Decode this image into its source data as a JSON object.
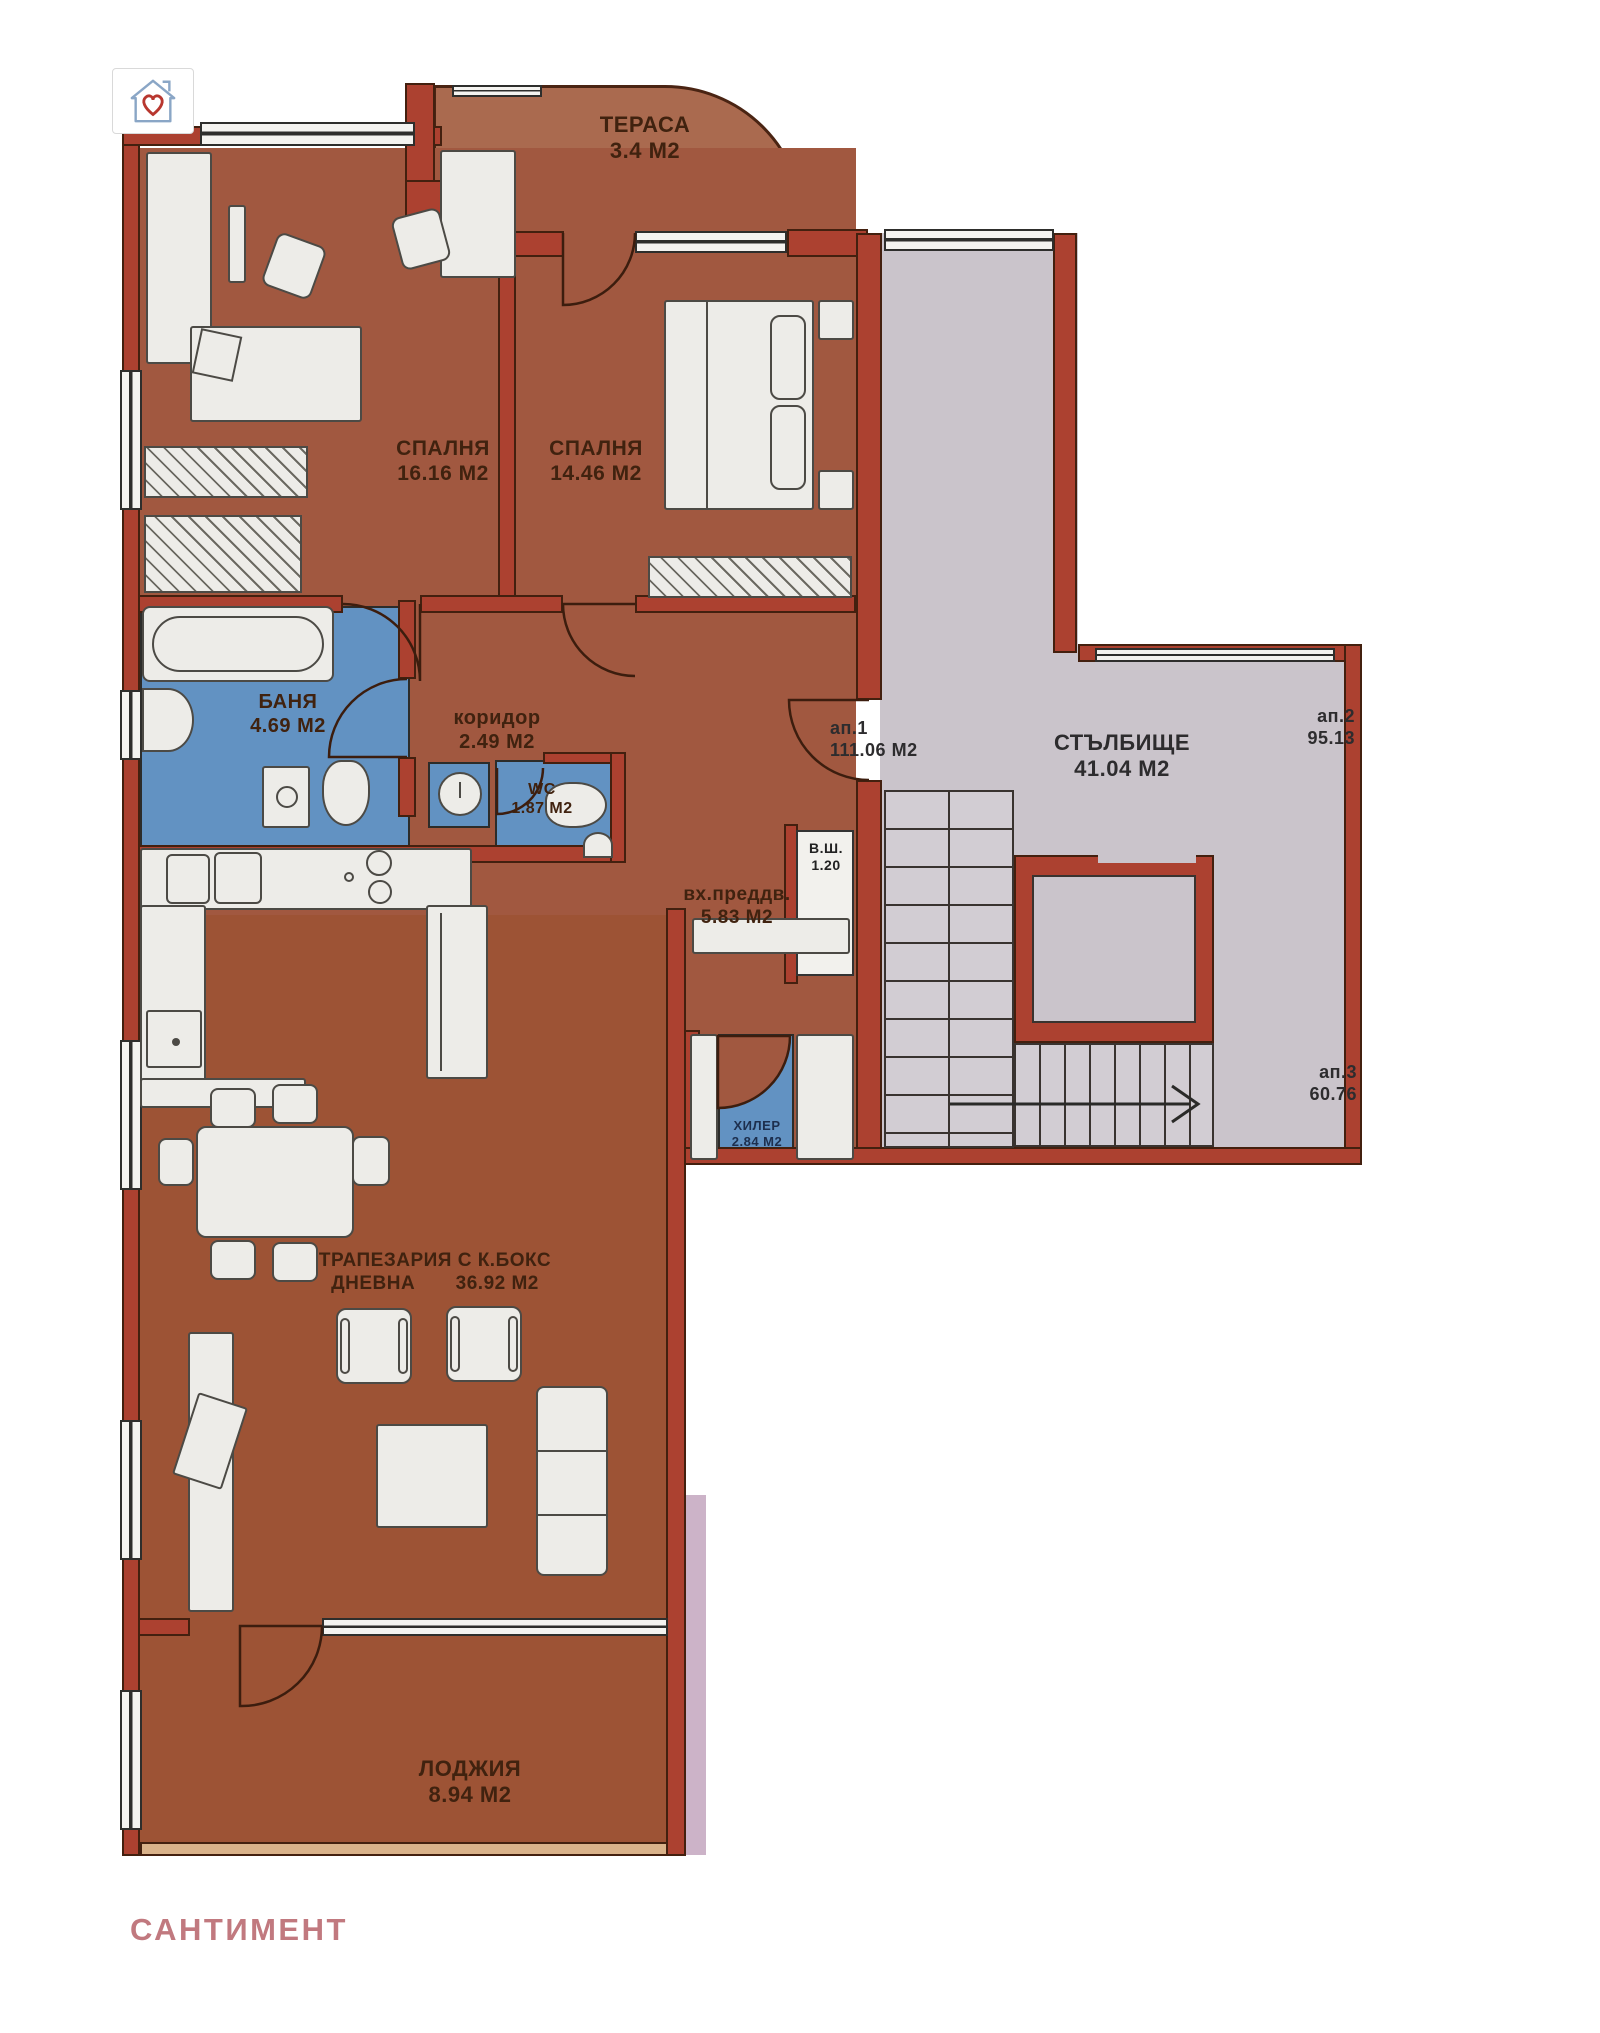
{
  "brand": {
    "text": "САНТИМЕНТ",
    "color": "#c1797f"
  },
  "logo": {
    "name": "house-with-heart-favorite"
  },
  "rooms": {
    "terrace": {
      "label": "ТЕРАСА",
      "area": "3.4 М2"
    },
    "bedroom1": {
      "label": "СПАЛНЯ",
      "area": "16.16 М2"
    },
    "bedroom2": {
      "label": "СПАЛНЯ",
      "area": "14.46 М2"
    },
    "bath": {
      "label": "БАНЯ",
      "area": "4.69 М2"
    },
    "corridor": {
      "label": "коридор",
      "area": "2.49 М2"
    },
    "wc": {
      "label": "WC",
      "area": "1.87 М2"
    },
    "entry": {
      "label": "вх.преддв.",
      "area": "5.83 М2"
    },
    "shaft": {
      "label": "В.Ш.",
      "area": "1.20"
    },
    "stairwell": {
      "label": "СТЪЛБИЩЕ",
      "area": "41.04 М2"
    },
    "storage": {
      "label": "ХИЛЕР",
      "area": "2.84 М2"
    },
    "living": {
      "label_line1": "ТРАПЕЗАРИЯ С К.БОКС",
      "label_line2": "ДНЕВНА",
      "area": "36.92 М2"
    },
    "loggia": {
      "label": "ЛОДЖИЯ",
      "area": "8.94 М2"
    }
  },
  "apartments": {
    "ap1": {
      "label": "ап.1",
      "area": "111.06 М2"
    },
    "ap2": {
      "label": "ап.2",
      "area": "95.13"
    },
    "ap3": {
      "label": "ап.3",
      "area": "60.76"
    }
  },
  "colors": {
    "floor": "#a15840",
    "terrace_floor": "#aa6a4f",
    "wall": "#ac4130",
    "stair_floor": "#cac4cb",
    "wet_room": "#6292c2",
    "loggia_sill": "#d9b28a",
    "brand_text": "#c1797f"
  }
}
